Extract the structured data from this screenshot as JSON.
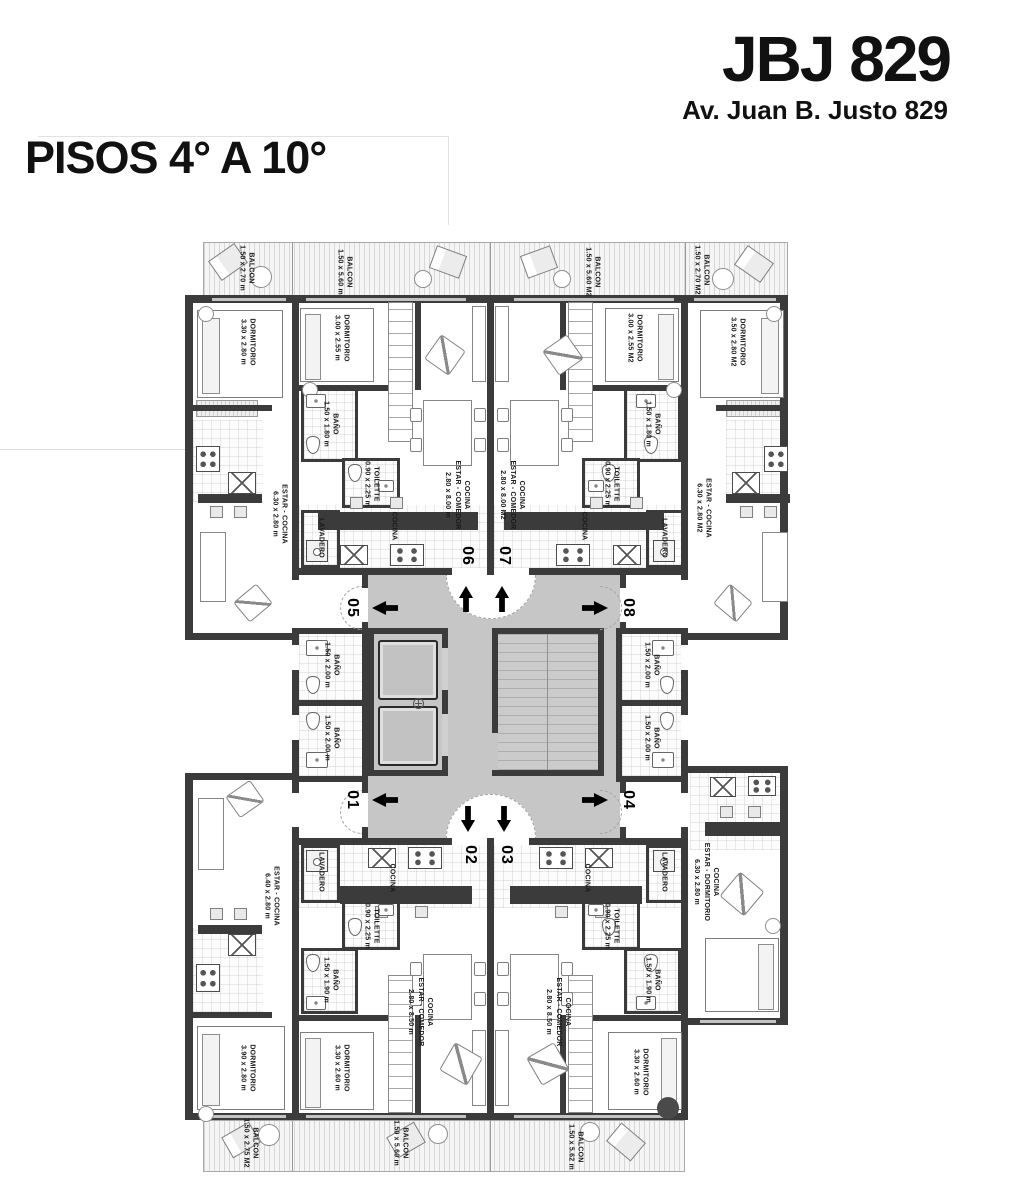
{
  "header": {
    "brand": "JBJ 829",
    "address": "Av. Juan B. Justo 829"
  },
  "title": "PISOS 4° A 10°",
  "palette": {
    "wall": "#3b3b3b",
    "corridor": "#c6c6c6",
    "text": "#111111"
  },
  "plan": {
    "units": {
      "u01": "01",
      "u02": "02",
      "u03": "03",
      "u04": "04",
      "u05": "05",
      "u06": "06",
      "u07": "07",
      "u08": "08"
    },
    "labels": {
      "balcon_tl": "BALCON\n1.50 x 2.70 m",
      "balcon_t06": "BALCON\n1.50 x 5.60 m",
      "balcon_t07": "BALCON\n1.50 x 5.60 M2",
      "balcon_tr": "BALCON\n1.50 x 2.70 M2",
      "dorm_05": "DORMITORIO\n3.30 x 2.80 m",
      "dorm_06": "DORMITORIO\n3.00 x 2.55 m",
      "dorm_07": "DORMITORIO\n3.00 x 2.55 M2",
      "dorm_08": "DORMITORIO\n3.50 x 2.80 M2",
      "bano_06": "BAÑO\n1.50 x 1.80 m",
      "bano_07": "BAÑO\n1.50 x 1.80 m",
      "toilette_06": "TOILETTE\n0.90 x 2.25 m",
      "toilette_07": "TOILETTE\n0.90 x 2.25 m",
      "comedor_06": "COCINA\nESTAR - COMEDOR\n2.80 x 8.00 m",
      "comedor_07": "COCINA\nESTAR - COMEDOR\n2.80 x 8.00 M2",
      "estar_05": "ESTAR - COCINA\n6.30 x 2.80 m",
      "estar_08": "ESTAR - COCINA\n6.30 x 2.80 M2",
      "cocina_06": "COCINA",
      "cocina_07": "COCINA",
      "lavadero_06": "LAVADERO",
      "lavadero_07": "LAVADERO",
      "bano_core_05": "BAÑO\n1.50 x 2.00 m",
      "bano_core_01": "BAÑO\n1.50 x 2.00 m",
      "bano_core_08": "BAÑO\n1.50 x 2.00 m",
      "bano_core_04": "BAÑO\n1.50 x 2.00 m",
      "estar_01": "ESTAR - COCINA\n6.40 x 2.80 m",
      "estar_04": "COCINA\nESTAR - DORMITORIO\n6.30 x 2.80 m",
      "comedor_02": "COCINA\nESTAR - COMEDOR\n2.80 x 8.50 m",
      "comedor_03": "COCINA\nESTAR - COMEDOR\n2.80 x 8.50 m",
      "cocina_02": "COCINA",
      "cocina_03": "COCINA",
      "lavadero_02": "LAVADERO",
      "lavadero_03": "LAVADERO",
      "toilette_02": "TOILETTE\n0.90 x 2.25 m",
      "toilette_03": "TOILETTE\n0.90 x 2.25 m",
      "bano_02": "BAÑO\n1.50 x 1.90 m",
      "bano_03": "BAÑO\n1.50 x 1.90 m",
      "dorm_01": "DORMITORIO\n3.90 x 2.80 m",
      "dorm_02": "DORMITORIO\n3.30 x 2.60 m",
      "dorm_03": "DORMITORIO\n3.30 x 2.60 m",
      "balcon_bl": "BALCON\n1.50 x 2.75 M2",
      "balcon_b2": "BALCON\n1.50 x 5.60 m",
      "balcon_b3": "BALCON\n1.50 x 5.62 m"
    }
  }
}
